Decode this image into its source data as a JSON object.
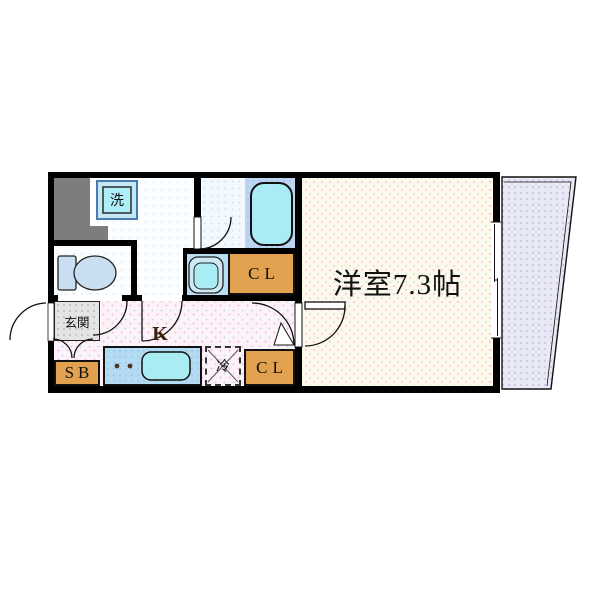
{
  "floorplan": {
    "unit_labels": {
      "western_room": "洋室7.3帖",
      "balcony": "バルコニー",
      "kitchen": "K",
      "entrance": "玄関",
      "washing_machine": "洗",
      "refrigerator": "冷",
      "closet_upper": "CL",
      "closet_lower": "CL",
      "shoe_box": "SB"
    },
    "colors": {
      "wall": "#000000",
      "closet_orange": "#e2a14e",
      "fixture_cyan": "#a9ecf4",
      "counter_blue": "#b3dcf2",
      "bath_panel_blue": "#bdd5f0",
      "toilet_blue": "#c9def1",
      "balcony_lavender": "#e9e9f6",
      "hall_pink": "#fdf2f8",
      "room_cream": "#fcf9ec",
      "entrance_gray": "#e4e4e4",
      "pipe_space_gray": "#7d7d7d"
    }
  }
}
